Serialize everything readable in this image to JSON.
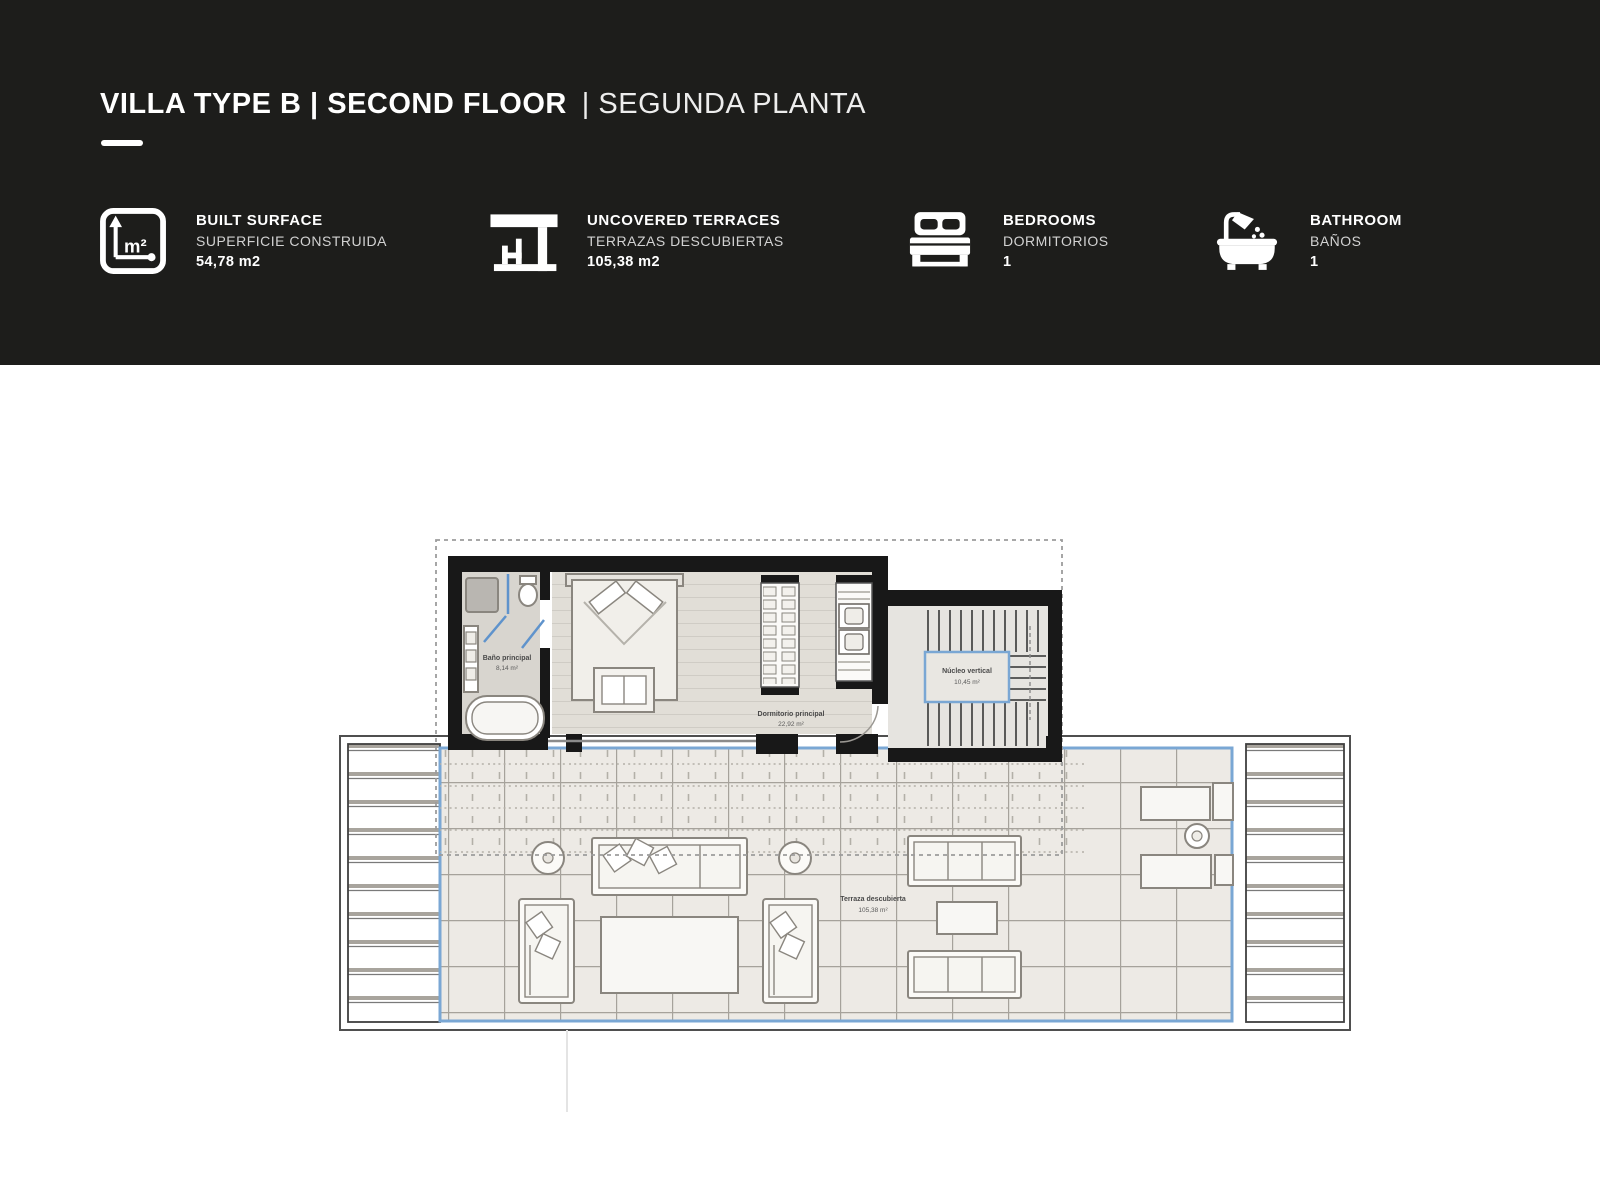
{
  "header": {
    "bg_color": "#1d1d1b",
    "title_bold": "VILLA TYPE B | SECOND FLOOR",
    "title_rest": "| SEGUNDA PLANTA",
    "stats": [
      {
        "icon": "area-m2-icon",
        "label": "BUILT SURFACE",
        "sublabel": "SUPERFICIE CONSTRUIDA",
        "value": "54,78 m2"
      },
      {
        "icon": "pergola-icon",
        "label": "UNCOVERED TERRACES",
        "sublabel": "TERRAZAS DESCUBIERTAS",
        "value": "105,38 m2"
      },
      {
        "icon": "bed-icon",
        "label": "BEDROOMS",
        "sublabel": "DORMITORIOS",
        "value": "1"
      },
      {
        "icon": "bathtub-icon",
        "label": "BATHROOM",
        "sublabel": "BAÑOS",
        "value": "1"
      }
    ]
  },
  "floorplan": {
    "accent_blue": "#7aa7d4",
    "wall_color": "#181818",
    "rooms": [
      {
        "name": "Baño principal",
        "area": "8,14 m²"
      },
      {
        "name": "Dormitorio principal",
        "area": "22,92 m²"
      },
      {
        "name": "Núcleo vertical",
        "area": "10,45 m²"
      },
      {
        "name": "Terraza descubierta",
        "area": "105,38 m²"
      }
    ]
  }
}
